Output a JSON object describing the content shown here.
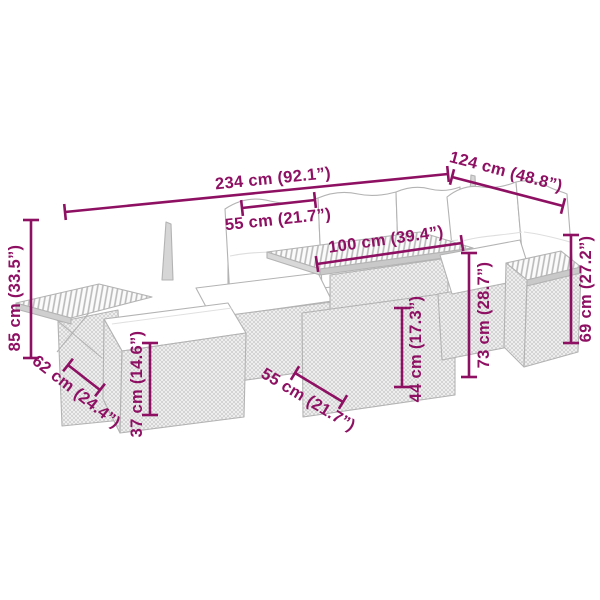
{
  "image": {
    "kind": "product-dimension-diagram",
    "subject": "modular poly rattan garden lounge set sketch with cushions, slat-top table, footstool and armrest shelves",
    "background": "#ffffff"
  },
  "colors": {
    "dimension_accent": "#8e1063",
    "sketch_outline": "#b3b3b3",
    "cushion_fill": "#ffffff"
  },
  "dims": {
    "total_width": {
      "label": "234 cm (92.1”)",
      "cm": 234,
      "inch": "92.1”"
    },
    "side_width": {
      "label": "124 cm (48.8”)",
      "cm": 124,
      "inch": "48.8”"
    },
    "cushion_width": {
      "label": "55 cm (21.7”)",
      "cm": 55,
      "inch": "21.7”"
    },
    "table_top_length": {
      "label": "100 cm (39.4”)",
      "cm": 100,
      "inch": "39.4”"
    },
    "back_height": {
      "label": "85 cm (33.5”)",
      "cm": 85,
      "inch": "33.5”"
    },
    "armrest_depth": {
      "label": "62 cm (24.4”)",
      "cm": 62,
      "inch": "24.4”"
    },
    "footstool_height": {
      "label": "37 cm (14.6”)",
      "cm": 37,
      "inch": "14.6”"
    },
    "seat_depth": {
      "label": "55 cm (21.7”)",
      "cm": 55,
      "inch": "21.7”"
    },
    "table_height": {
      "label": "44 cm (17.3”)",
      "cm": 44,
      "inch": "17.3”"
    },
    "sofa_height": {
      "label": "73 cm (28.7”)",
      "cm": 73,
      "inch": "28.7”"
    },
    "armrest_height": {
      "label": "69 cm (27.2”)",
      "cm": 69,
      "inch": "27.2”"
    }
  }
}
